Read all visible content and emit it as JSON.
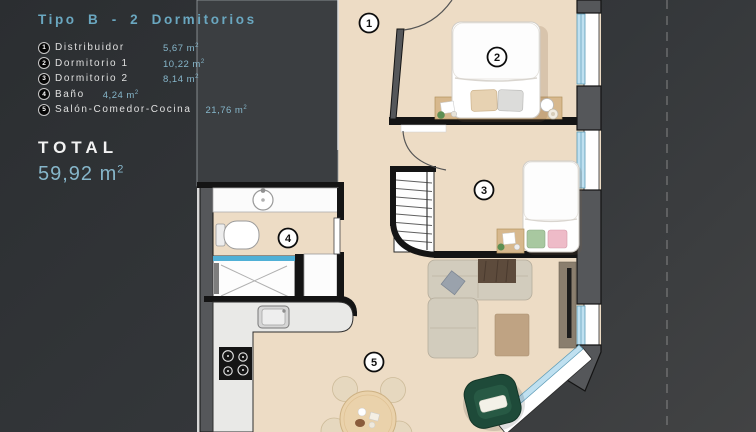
{
  "panel": {
    "title": "Tipo B - 2 Dormitorios",
    "legend": {
      "items": [
        {
          "num": "1",
          "label": "Distribuidor",
          "area": "5,67"
        },
        {
          "num": "2",
          "label": "Dormitorio 1",
          "area": "10,22"
        },
        {
          "num": "3",
          "label": "Dormitorio 2",
          "area": "8,14"
        },
        {
          "num": "4",
          "label": "Baño",
          "area": "4,24"
        },
        {
          "num": "5",
          "label": "Salón-Comedor-Cocina",
          "area": "21,76"
        }
      ],
      "unit": "m",
      "unit_exp": "2"
    },
    "total": {
      "label": "TOTAL",
      "value": "59,92",
      "unit": "m",
      "unit_exp": "2"
    }
  },
  "plan": {
    "room_markers": [
      {
        "number": "1",
        "name": "distribuidor"
      },
      {
        "number": "2",
        "name": "dormitorio-1"
      },
      {
        "number": "3",
        "name": "dormitorio-2"
      },
      {
        "number": "4",
        "name": "bano"
      },
      {
        "number": "5",
        "name": "salon-comedor-cocina"
      }
    ]
  },
  "colors": {
    "accent_blue": "#86b6ca",
    "panel_bg": "#2b2e31",
    "outside_bg": "#3e3f41",
    "floor_beige": "#eddcc5",
    "wall_gray": "#55575a",
    "window_glass": "#bfe0f0",
    "armchair_green": "#1e4a39"
  }
}
